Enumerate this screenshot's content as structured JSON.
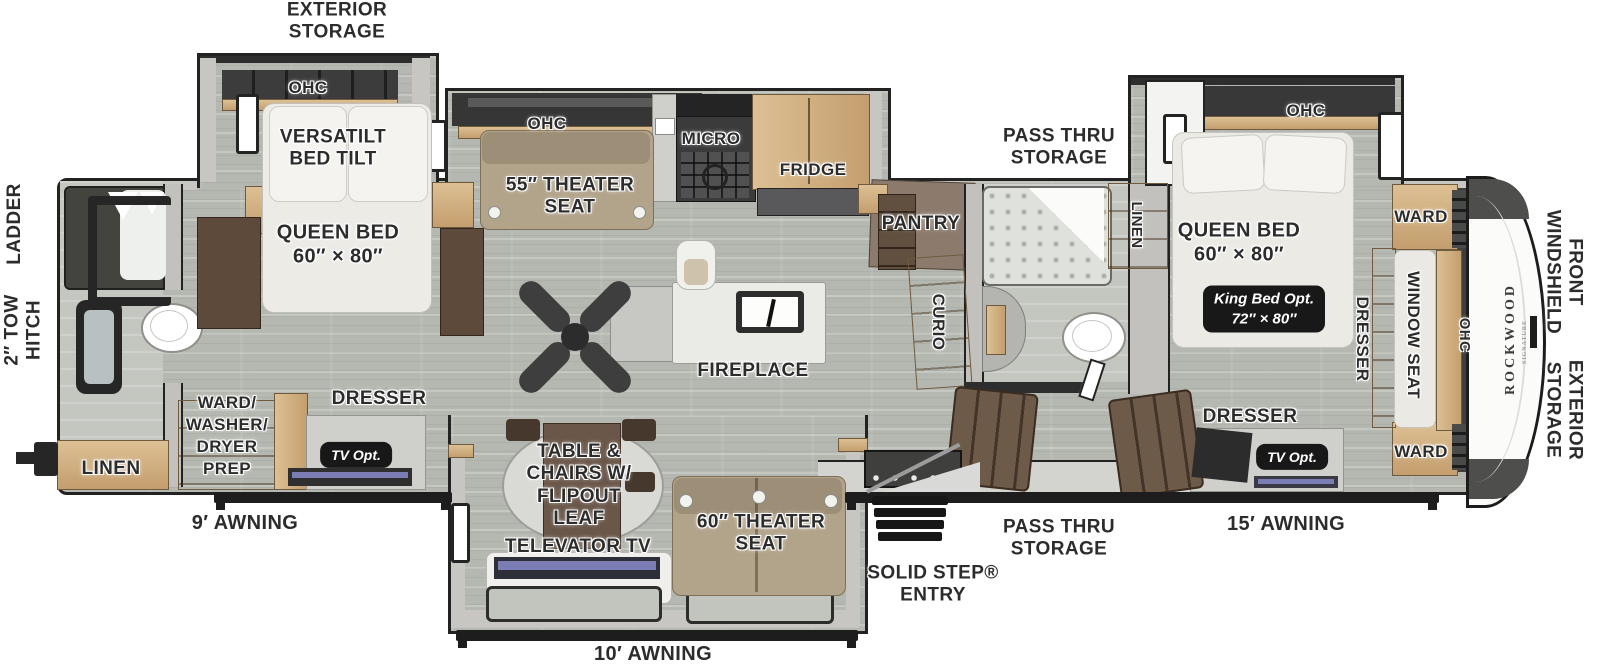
{
  "side": {
    "ladder": "LADDER",
    "tow_hitch": "2″ TOW\nHITCH",
    "front_windshield": "FRONT\nWINDSHIELD",
    "exterior_storage_front": "EXTERIOR\nSTORAGE"
  },
  "exterior": {
    "storage_rear": "EXTERIOR\nSTORAGE",
    "awning_rear": "9′ AWNING",
    "awning_mid": "10′ AWNING",
    "awning_front": "15′ AWNING",
    "solid_step_entry": "SOLID STEP®\nENTRY",
    "pass_thru_top": "PASS THRU\nSTORAGE",
    "pass_thru_bottom": "PASS THRU\nSTORAGE"
  },
  "rear_bedroom": {
    "ohc": "OHC",
    "versatilt": "VERSATILT\nBED TILT",
    "queen_bed": "QUEEN BED\n60″ × 80″"
  },
  "rear_closets": {
    "linen": "LINEN",
    "ward_washer_dryer": "WARD/\nWASHER/\nDRYER\nPREP",
    "dresser": "DRESSER",
    "tv_opt": "TV Opt."
  },
  "kitchen": {
    "ohc": "OHC",
    "theater_seat_55": "55″ THEATER\nSEAT",
    "micro": "MICRO",
    "fridge": "FRIDGE",
    "pantry": "PANTRY",
    "curio": "CURIO",
    "fireplace": "FIREPLACE"
  },
  "living": {
    "table_chairs": "TABLE &\nCHAIRS W/\nFLIPOUT\nLEAF",
    "televator_tv": "TELEVATOR TV",
    "theater_seat_60": "60″ THEATER\nSEAT"
  },
  "mid_bath": {
    "linen": "LINEN"
  },
  "front_bedroom": {
    "ohc": "OHC",
    "queen_bed": "QUEEN BED\n60″ × 80″",
    "king_bed_opt": "King Bed Opt.\n72″ × 80″",
    "ward_top": "WARD",
    "ward_bottom": "WARD",
    "dresser_side": "DRESSER",
    "dresser_front": "DRESSER",
    "tv_opt": "TV Opt.",
    "window_seat": "WINDOW SEAT",
    "ohc_side": "OHC"
  },
  "brand": {
    "name": "ROCKWOOD",
    "series": "SIGNATURE"
  },
  "colors": {
    "floor": "#b5b8b0",
    "wall": "#c7c6c2",
    "outline": "#222222",
    "wood": "#d2b384",
    "dark_wood": "#5e4a3a",
    "seat_tan": "#b2a38b",
    "badge_bg": "#181818",
    "screen_purple": "#7b7db4"
  }
}
